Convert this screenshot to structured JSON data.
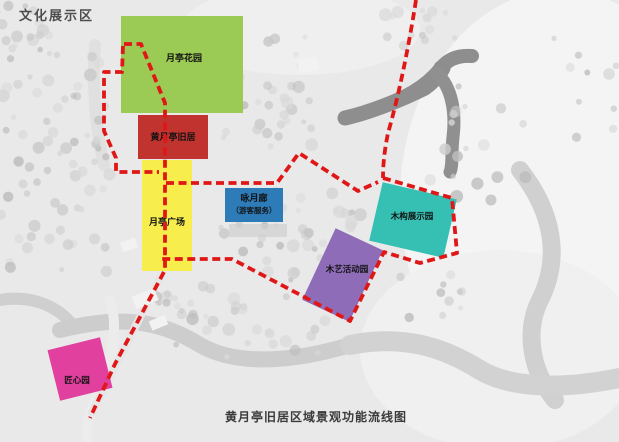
{
  "title": "文化展示区",
  "caption": "黄月亭旧居区域景观功能流线图",
  "colors": {
    "route": "#e01717",
    "base": "#e9e9e9"
  },
  "zones": [
    {
      "name": "yueting-flower-garden",
      "label": "月亭花园",
      "color": "#9ccb55"
    },
    {
      "name": "huang-yueting-residence",
      "label": "黄月亭旧居",
      "color": "#c1332f"
    },
    {
      "name": "yueting-plaza",
      "label": "月亭广场",
      "color": "#f7ee4d"
    },
    {
      "name": "moon-corridor",
      "label": "咏月廊",
      "sublabel": "（游客服务）",
      "color": "#2d7cb8"
    },
    {
      "name": "wood-structure-display-garden",
      "label": "木构展示园",
      "color": "#36c0b4"
    },
    {
      "name": "wood-craft-activity-garden",
      "label": "木艺活动园",
      "color": "#8f6cb8"
    },
    {
      "name": "craftsmanship-garden",
      "label": "匠心园",
      "color": "#e2409f"
    }
  ]
}
